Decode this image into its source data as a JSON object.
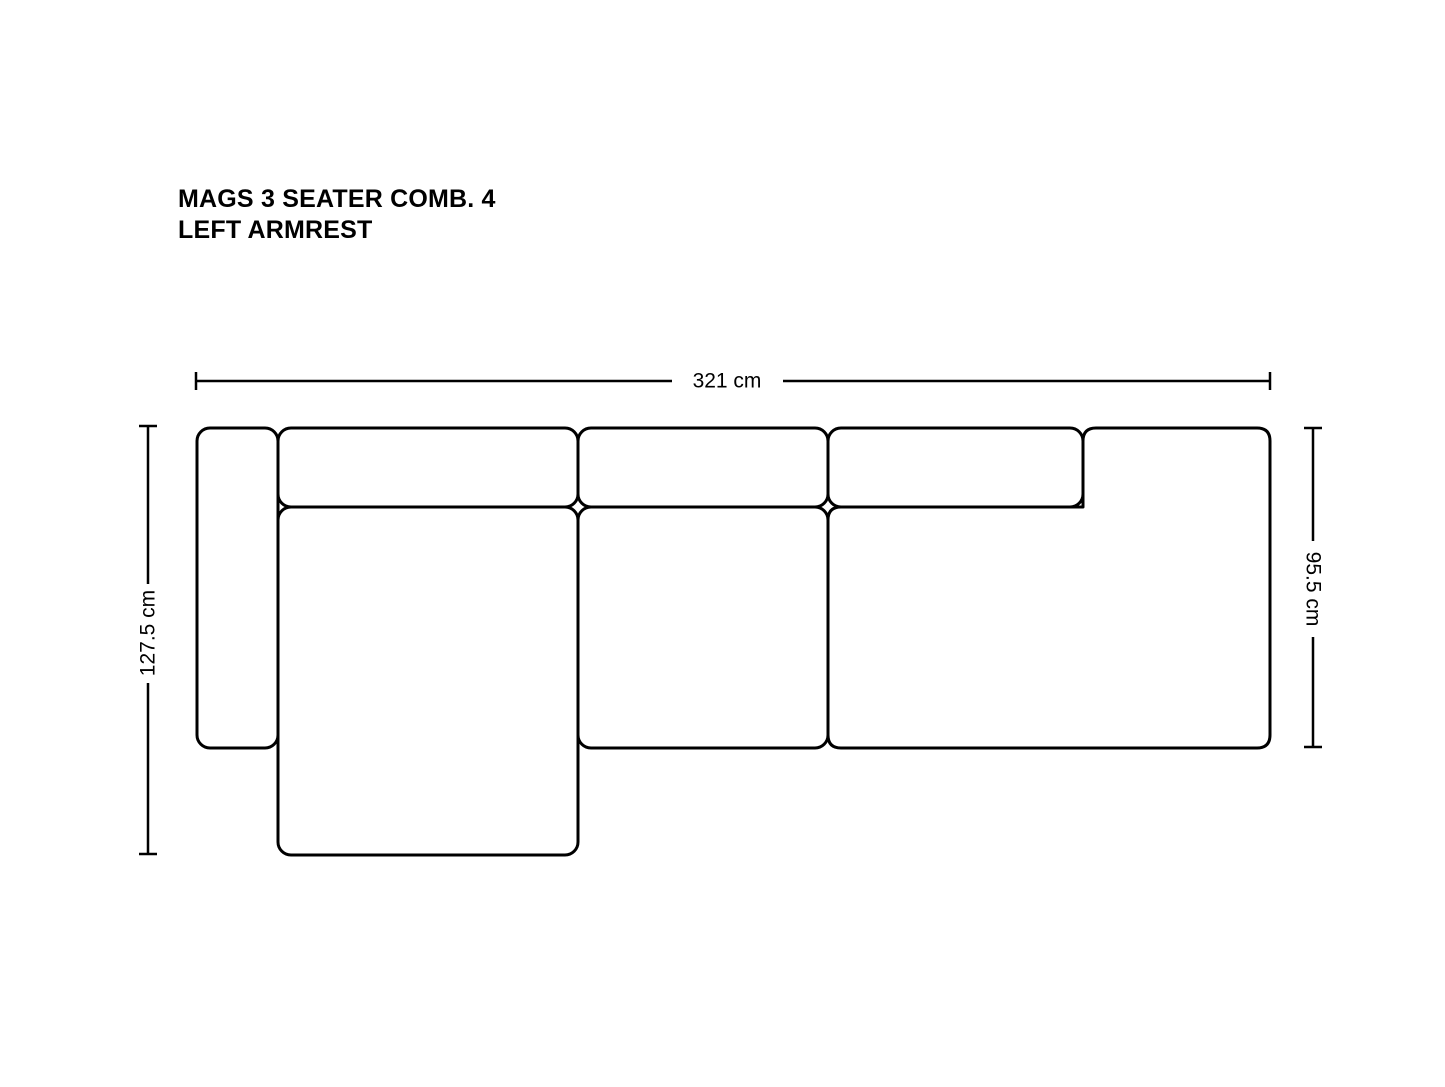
{
  "title": {
    "line1": "MAGS 3 SEATER COMB. 4",
    "line2": "LEFT ARMREST"
  },
  "dimensions": {
    "overall_width": "321 cm",
    "left_depth": "127.5 cm",
    "right_depth": "95.5 cm"
  },
  "modules": [
    "left-armrest",
    "backrest-cushion-left",
    "backrest-cushion-middle",
    "backrest-cushion-right",
    "chaise-longue-seat",
    "middle-seat",
    "right-lounge-seat"
  ],
  "colors": {
    "line": "#000000",
    "text": "#000000",
    "background": "#ffffff"
  }
}
